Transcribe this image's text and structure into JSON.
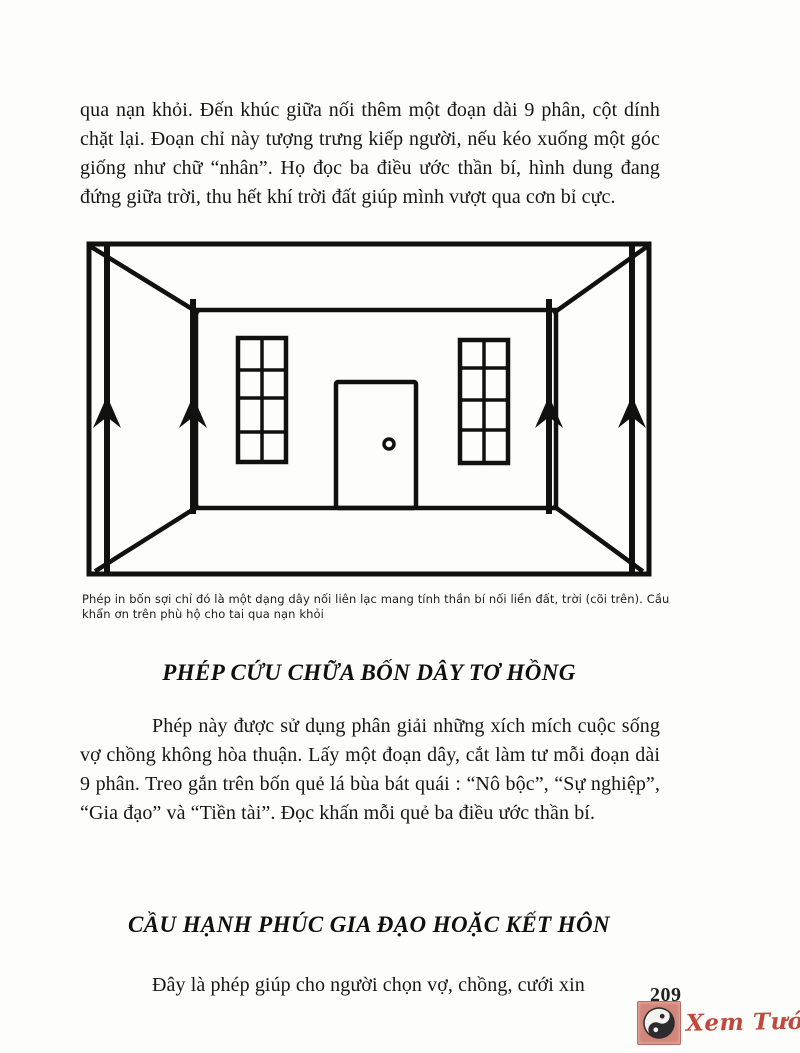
{
  "page": {
    "number": "209",
    "background": "#fdfdfb",
    "text_color": "#161616"
  },
  "content": {
    "paragraph1": "qua nạn khỏi. Đến khúc giữa nối thêm một đoạn dài 9 phân, cột dính chặt lại. Đoạn chỉ này tượng trưng kiếp người, nếu kéo xuống một góc giống như chữ “nhân”. Họ đọc ba điều ước thần bí, hình dung đang đứng giữa trời, thu hết khí trời đất giúp mình vượt qua cơn bỉ cực.",
    "figure": {
      "illustration_name": "room-perspective-with-four-hanging-threads",
      "caption": "Phép in bốn sợi chỉ đó là một dạng dây nối liên lạc mang tính thần bí nối liền đất, trời (cõi trên). Cầu khẩn ơn trên phù hộ cho tai qua nạn khỏi"
    },
    "heading1": "PHÉP CỨU CHỮA BỐN DÂY TƠ HỒNG",
    "paragraph2": "Phép này được sử dụng phân giải những xích mích cuộc sống vợ chồng không hòa thuận. Lấy một đoạn dây, cắt làm tư mỗi đoạn dài 9 phân. Treo gắn trên bốn quẻ lá bùa bát quái : “Nô bộc”, “Sự nghiệp”, “Gia đạo” và “Tiền tài”. Đọc khấn mỗi quẻ ba điều ước thần bí.",
    "heading2": "CẦU HẠNH PHÚC GIA ĐẠO HOẶC KẾT HÔN",
    "paragraph3": "Đây là phép giúp cho người chọn vợ, chồng, cưới xin"
  },
  "watermark": {
    "text": "Xem Tướng.net",
    "icon": "yin-yang-icon",
    "text_color": "#c2483c",
    "logo_background": "#d2857a",
    "yin_yang_dark": "#2c2c2c"
  }
}
